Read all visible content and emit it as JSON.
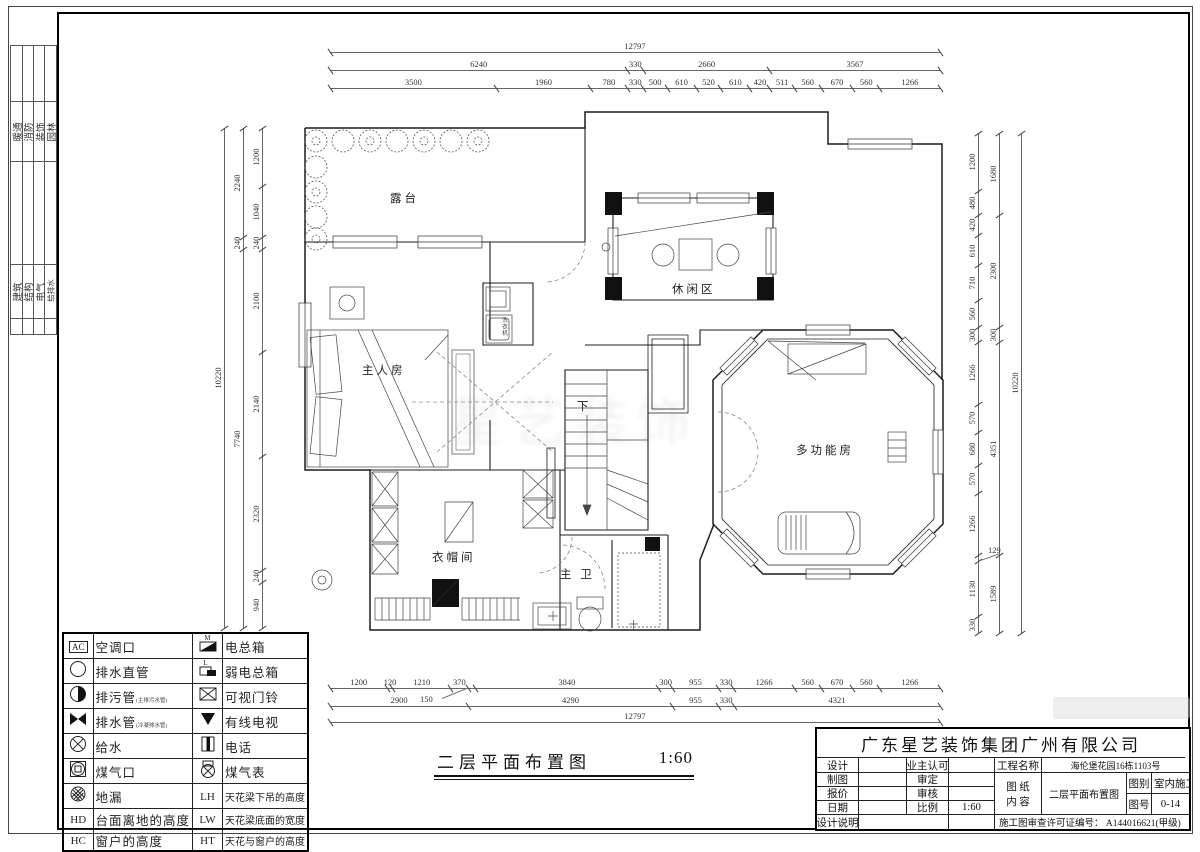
{
  "sidebar": {
    "group1": [
      "暖通",
      "消防",
      "装饰",
      "园林"
    ],
    "group2": [
      "建筑",
      "结构",
      "电气",
      "给排水"
    ]
  },
  "plan": {
    "rooms": {
      "terrace": "露台",
      "leisure": "休闲区",
      "master": "主人房",
      "down": "下",
      "multi": "多功能房",
      "cloak": "衣帽间",
      "bath": "主 卫",
      "washer": "洗衣机"
    }
  },
  "dimensions": {
    "top": {
      "total": [
        12797
      ],
      "mid": [
        6240,
        330,
        2660,
        3567
      ],
      "inner": [
        3500,
        1960,
        780,
        330,
        500,
        610,
        520,
        610,
        420,
        511,
        560,
        670,
        560,
        1266
      ]
    },
    "bottom": {
      "inner": [
        1200,
        120,
        1210,
        370,
        150,
        3840,
        300,
        955,
        330,
        1266,
        560,
        670,
        560,
        1266
      ],
      "mid": [
        2900,
        4290,
        955,
        330,
        4321
      ],
      "total": [
        12797
      ],
      "note": "150"
    },
    "left": {
      "inner": [
        1200,
        1040,
        240,
        2100,
        2140,
        2320,
        240,
        940
      ],
      "mid": [
        2240,
        240,
        7740
      ],
      "total": [
        10220
      ]
    },
    "right": {
      "inner": [
        1200,
        480,
        420,
        610,
        710,
        560,
        300,
        1266,
        570,
        680,
        570,
        1266,
        129,
        1130,
        330
      ],
      "mid": [
        1680,
        2300,
        300,
        4351,
        1589
      ],
      "total": [
        10220
      ],
      "note": "129"
    }
  },
  "legend": {
    "rows": [
      {
        "s1": "text:AC",
        "l1": "空调口",
        "s2": "m-box",
        "l2": "电总箱"
      },
      {
        "s1": "circle",
        "l1": "排水直管",
        "s2": "l-box",
        "l2": "弱电总箱"
      },
      {
        "s1": "half-circle",
        "l1": "排污管",
        "sub1": "(主排污水管)",
        "s2": "box-x",
        "l2": "可视门铃"
      },
      {
        "s1": "bowtie",
        "l1": "排水管",
        "sub1": "(冷凝排水管)",
        "s2": "tri-down",
        "l2": "有线电视"
      },
      {
        "s1": "circle-x",
        "l1": "给水",
        "s2": "phone",
        "l2": "电话"
      },
      {
        "s1": "circle-square",
        "l1": "煤气口",
        "s2": "gas-meter",
        "l2": "煤气表"
      },
      {
        "s1": "drain",
        "l1": "地漏",
        "s2": "text:LH",
        "l2": "天花梁下吊的高度"
      },
      {
        "s1": "text:HD",
        "l1": "台面离地的高度",
        "s2": "text:LW",
        "l2": "天花梁底面的宽度"
      },
      {
        "s1": "text:HC",
        "l1": "窗户的高度",
        "s2": "text:HT",
        "l2": "天花与窗户的高度"
      }
    ]
  },
  "caption": {
    "title": "二层平面布置图",
    "scale": "1:60"
  },
  "titleblock": {
    "company": "广东星艺装饰集团广州有限公司",
    "design": "设计",
    "owner_ok": "业主认可",
    "draft": "制图",
    "approve": "审定",
    "quote": "报价",
    "check": "审核",
    "date": "日期",
    "scale_label": "比例",
    "scale": "1:60",
    "notes": "设计说明",
    "project_label": "工程名称",
    "project": "海伦堡花园16栋1103号",
    "sheet_label": "图 纸 内 容",
    "sheet_content": "二层平面布置图",
    "cat_label": "图别",
    "cat": "室内施工",
    "no_label": "图号",
    "no": "0-14",
    "permit": "施工图审查许可证编号：  A144016621(甲级)"
  },
  "watermark": "星艺装饰"
}
